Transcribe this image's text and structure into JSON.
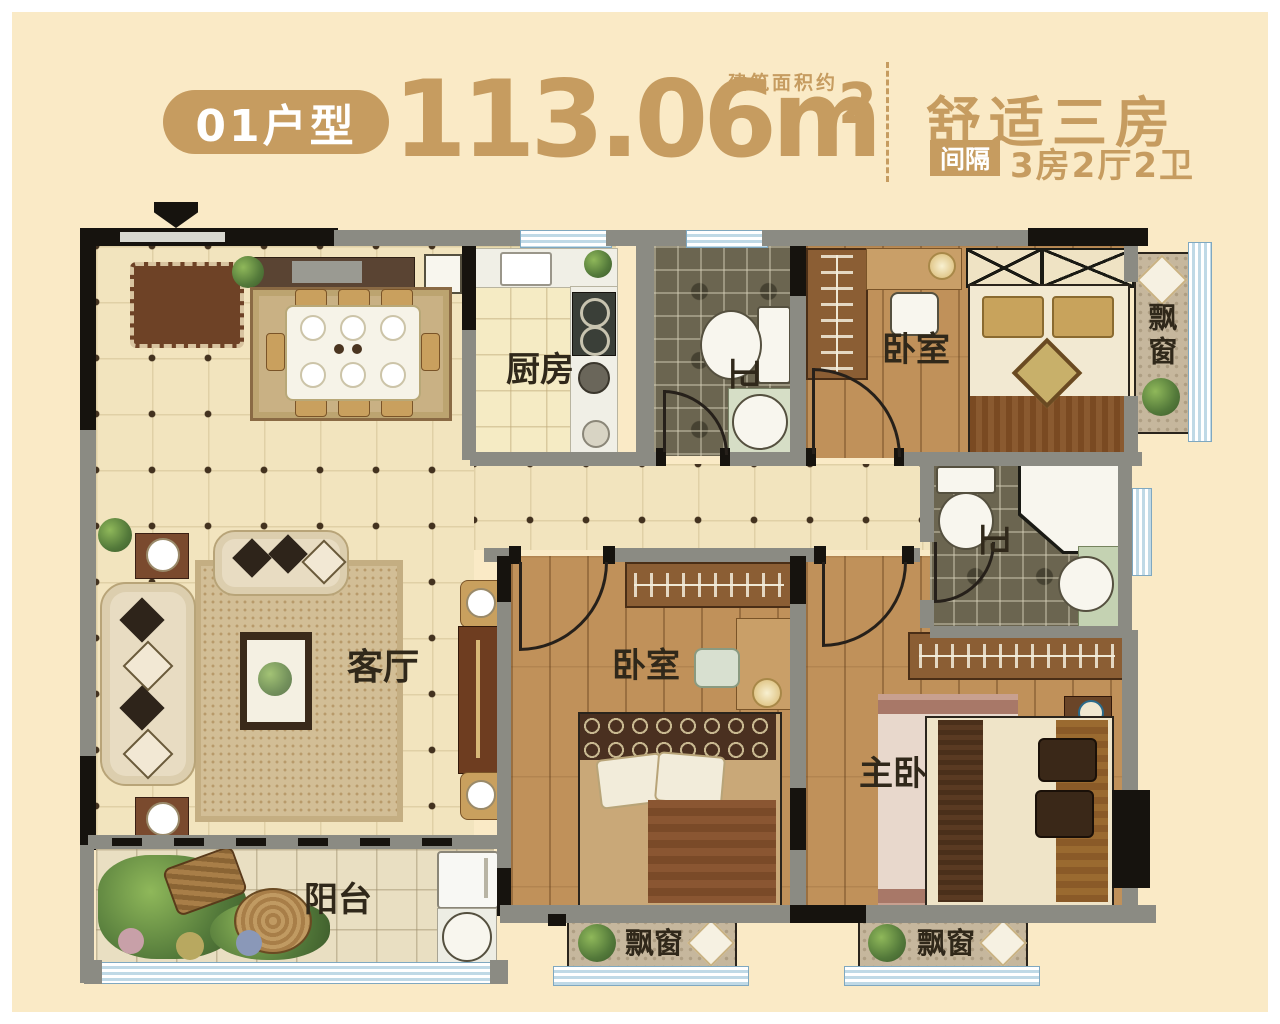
{
  "header": {
    "unit_badge": "01户型",
    "area_value": "113.06m",
    "area_sup": "2",
    "area_note": "建筑面积约",
    "headline": "舒适三房",
    "spec_tag": "间隔",
    "spec_text": "3房2厅2卫"
  },
  "rooms": {
    "kitchen": "厨房",
    "bath_top": "卫",
    "bedroom_top": "卧室",
    "bay_right": "飘窗",
    "bath_mid": "卫",
    "living": "客厅",
    "bedroom_mid": "卧室",
    "master_bedroom": "主卧",
    "balcony": "阳台",
    "bay_bottom_left": "飘窗",
    "bay_bottom_right": "飘窗"
  },
  "colors": {
    "accent_gold": "#C69C60",
    "page_background": "#FAEAC6",
    "wall_gray": "#8B8B83",
    "wall_black": "#1A1A1A",
    "window_blue": "#BFD9E6",
    "wood_floor": "#C0915A",
    "tile_floor": "#F2E4BE"
  }
}
